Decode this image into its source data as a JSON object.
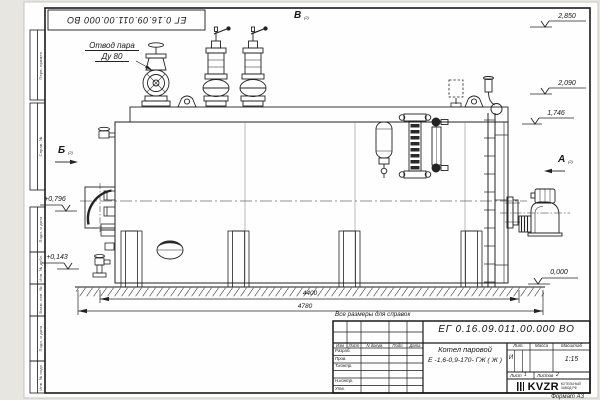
{
  "sheet": {
    "stamp_number": "ЕГ 0.16.09.011.00.000  ВО",
    "note": "Все размеры для справок",
    "format": "Формат А3"
  },
  "margins": [
    {
      "label": "Перв. примен."
    },
    {
      "label": "Справ. №"
    },
    {
      "label": "Подп. и дата"
    },
    {
      "label": "Инв. № дубл."
    },
    {
      "label": "Взам. инв. №"
    },
    {
      "label": "Подп. и дата"
    },
    {
      "label": "Инв. № подл."
    }
  ],
  "callout": {
    "line1": "Отвод пара",
    "line2": "Ду 80"
  },
  "views": {
    "top": {
      "letter": "В",
      "ref": "(2)"
    },
    "left": {
      "letter": "Б",
      "ref": "(2)"
    },
    "right": {
      "letter": "А",
      "ref": "(2)"
    }
  },
  "elevations": {
    "e2850": "2,850",
    "e2090": "2,090",
    "e1746": "1,746",
    "e0796": "+0,796",
    "e0143": "+0,143",
    "e0000": "0,000"
  },
  "dims": {
    "inner": "4400",
    "overall": "4780"
  },
  "title_block": {
    "designation": "ЕГ 0.16.09.011.00.000  ВО",
    "name_line1": "Котел паровой",
    "name_line2": "Е -1,6-0,9-170- ГЖ ( Ж )",
    "cols": {
      "izm": "Изм",
      "list": "Лист",
      "doc": "N докум.",
      "podp": "Подп.",
      "date": "Дата"
    },
    "rows": [
      {
        "label": "Разраб."
      },
      {
        "label": "Пров."
      },
      {
        "label": "Т.контр."
      },
      {
        "label": "Н.контр."
      },
      {
        "label": "Утв."
      }
    ],
    "lit_label": "Лит.",
    "lit_value": "И",
    "mass_label": "Масса",
    "scale_label": "Масштаб",
    "scale_value": "1:15",
    "sheet_label": "Лист",
    "sheet_value": "1",
    "sheets_label": "Листов",
    "sheets_value": "2",
    "company": {
      "logo": "KVZR",
      "sub1": "КОТЕЛЬНЫЙ",
      "sub2": "ЗАВОД РФ"
    }
  }
}
